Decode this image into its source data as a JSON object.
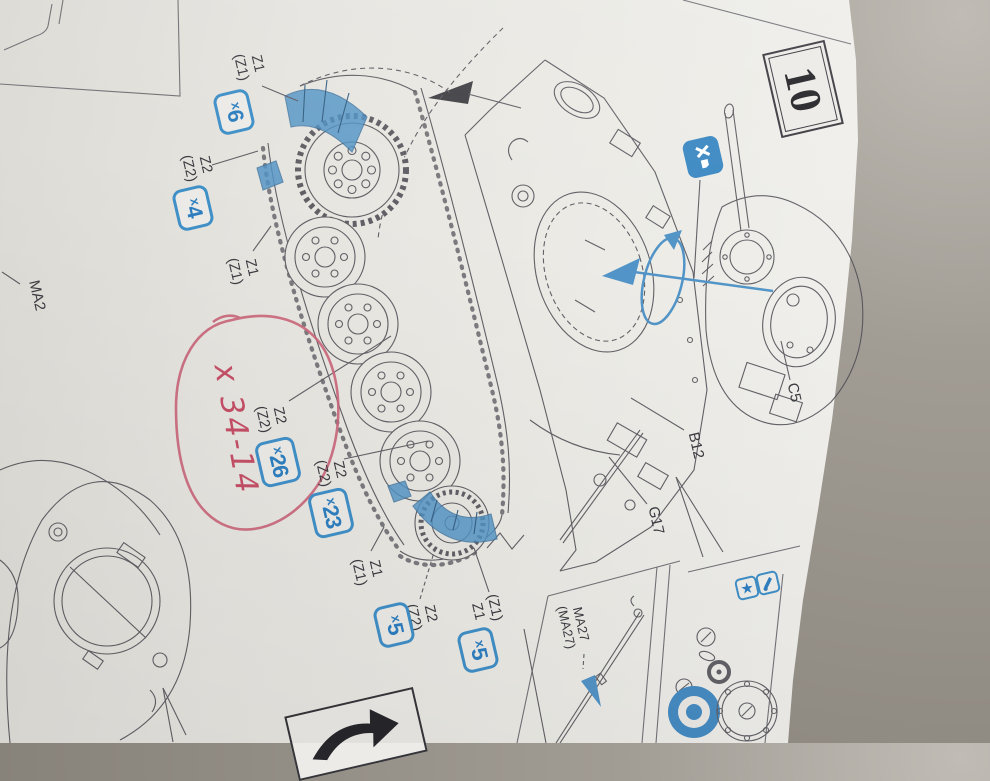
{
  "step": {
    "number": "10"
  },
  "callouts": {
    "c1": {
      "line1": "Z1",
      "line2": "(Z1)",
      "qty_x": "x",
      "qty_n": "6"
    },
    "c2": {
      "line1": "Z2",
      "line2": "(Z2)",
      "qty_x": "x",
      "qty_n": "4"
    },
    "c3": {
      "line1": "Z1",
      "line2": "(Z1)"
    },
    "c4": {
      "line1": "Z2",
      "line2": "(Z2)",
      "qty_x": "x",
      "qty_n": "26"
    },
    "c5": {
      "line1": "Z2",
      "line2": "(Z2)",
      "qty_x": "x",
      "qty_n": "23"
    },
    "c6": {
      "line1": "Z1",
      "line2": "(Z1)"
    },
    "c7": {
      "line1": "Z2",
      "line2": "(Z2)",
      "qty_x": "x",
      "qty_n": "5"
    },
    "c8": {
      "line1": "(Z1)",
      "line2": "Z1",
      "qty_x": "x",
      "qty_n": "5"
    }
  },
  "part_labels": {
    "ma2": "MA2",
    "b12": "B12",
    "g17": "G17",
    "c5": "C5",
    "ma27_line1": "MA27",
    "ma27_line2": "(MA27)"
  },
  "annotations": {
    "handwritten_note": "x 34-14"
  },
  "icons": {
    "star": "★",
    "no_glue_x": "x"
  },
  "colors": {
    "accent_blue": "#3d89c3",
    "pen_red": "#c44f66",
    "ink": "#3c3c42",
    "paper": "#e9e7e2",
    "backdrop": "#97928a"
  }
}
